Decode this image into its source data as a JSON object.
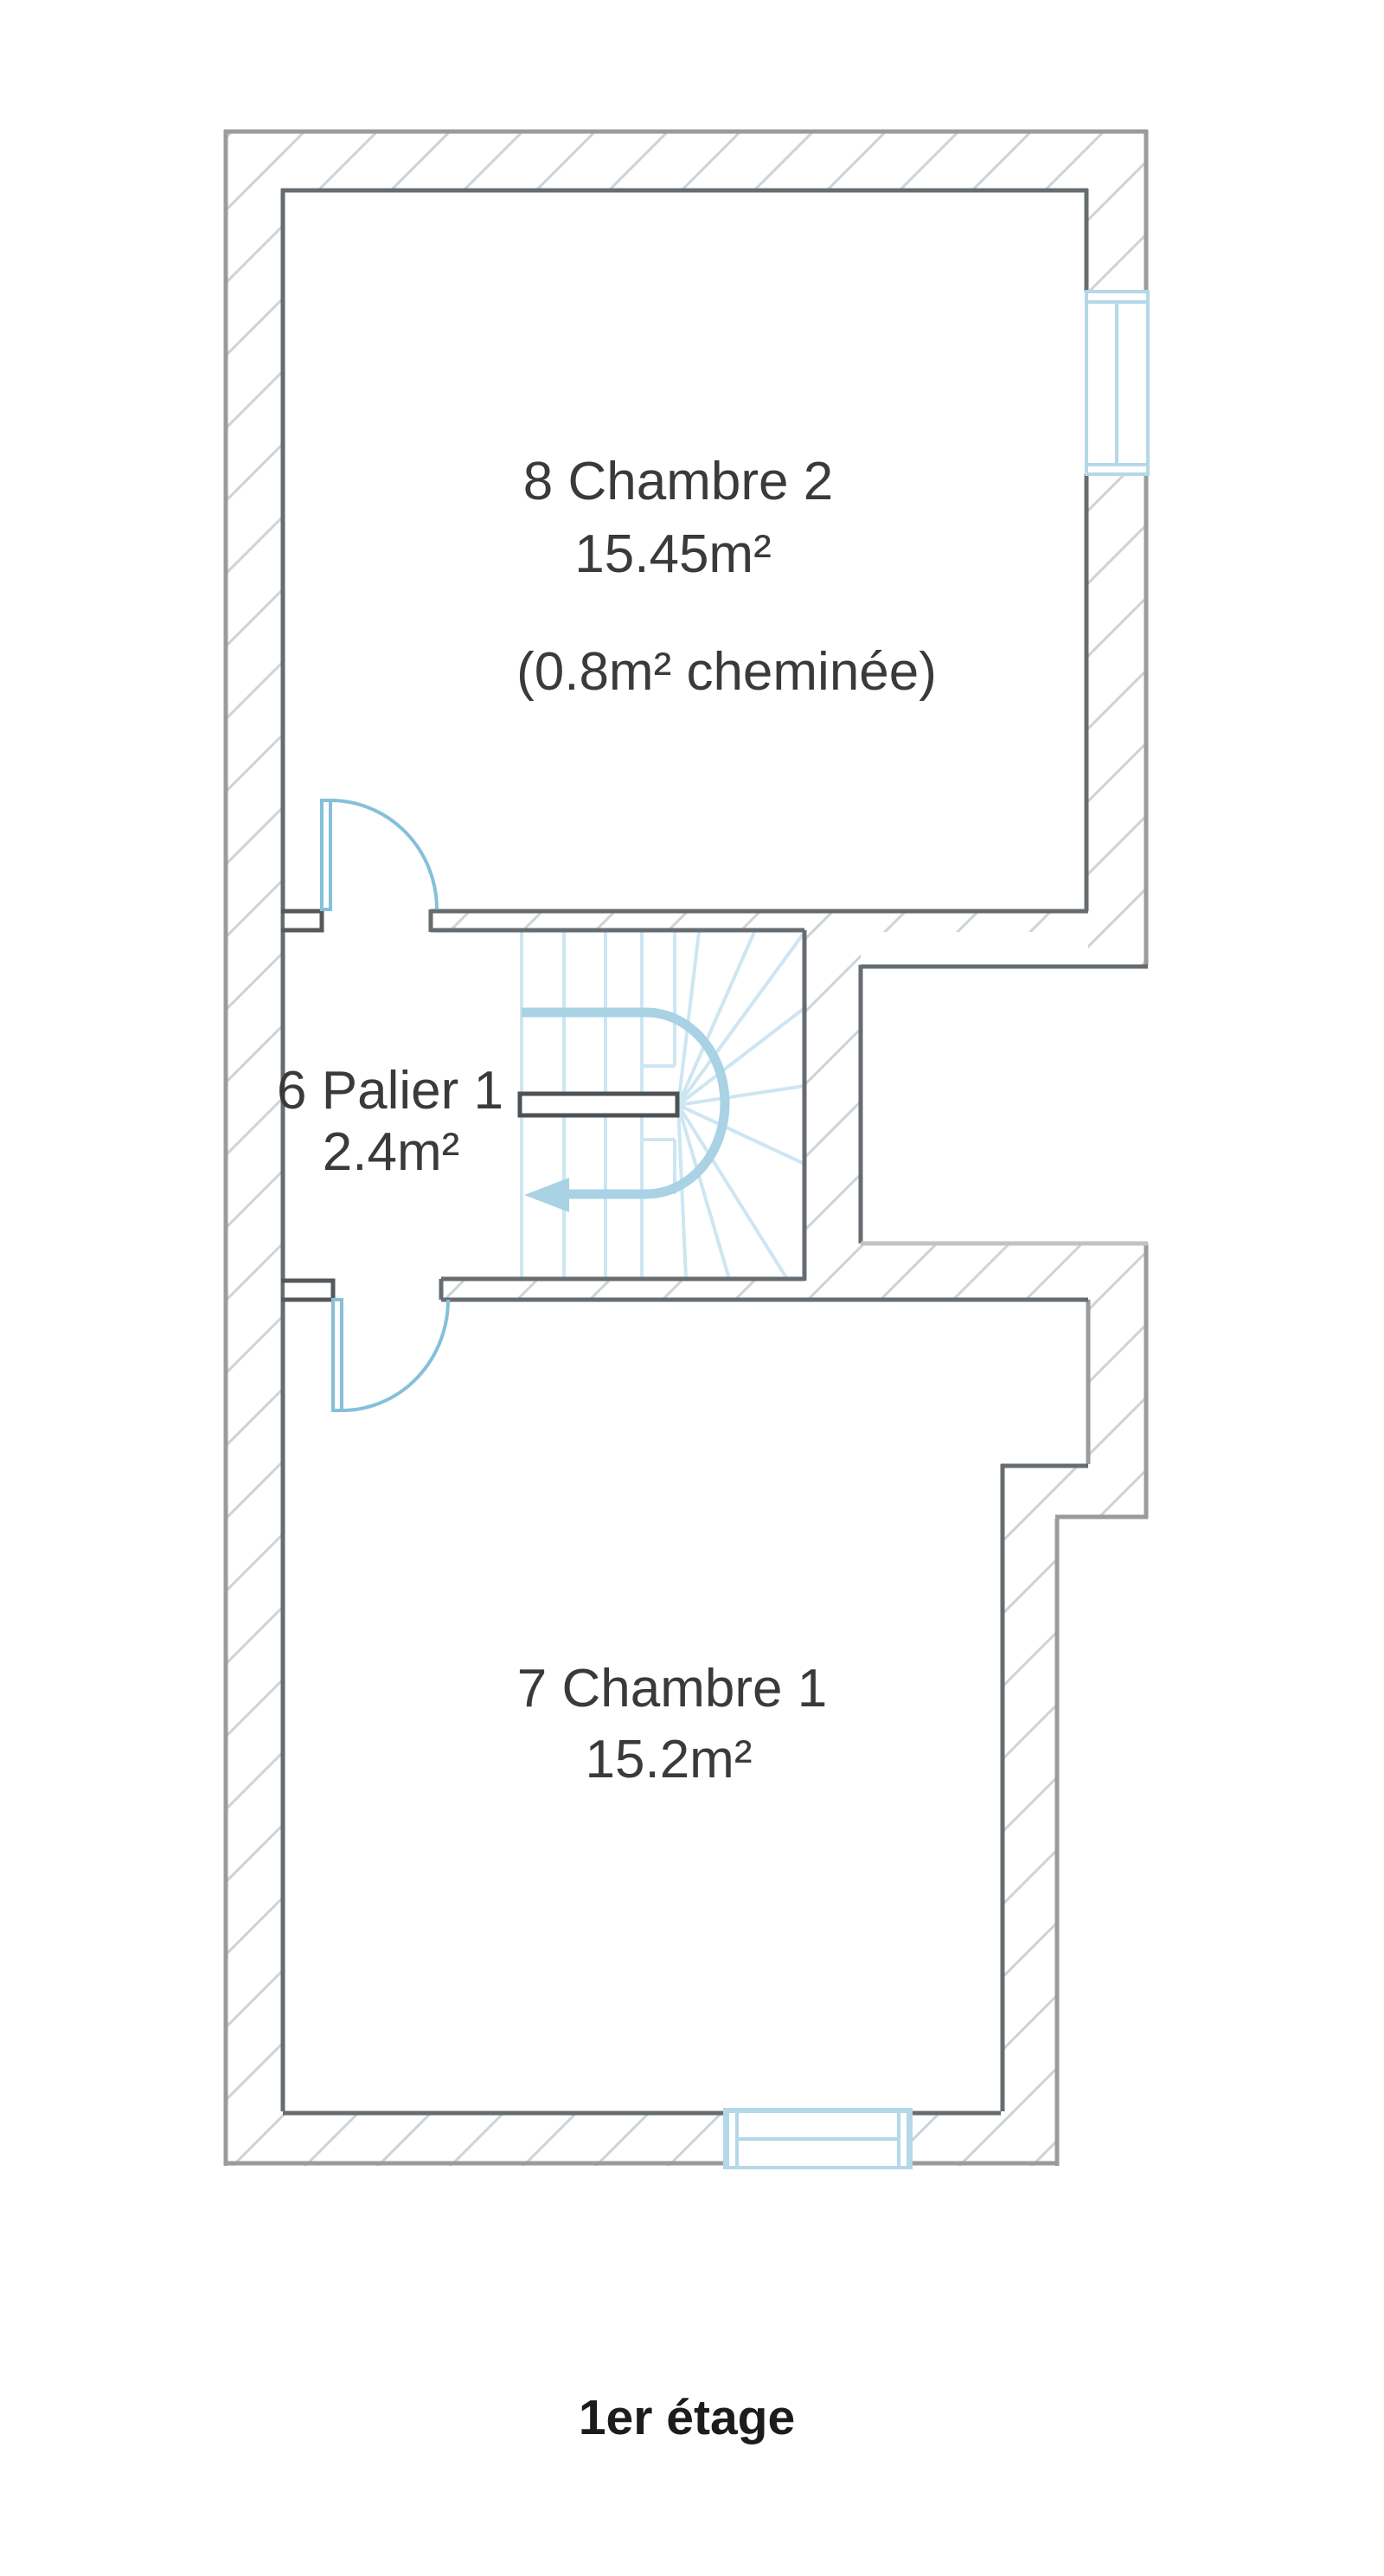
{
  "page": {
    "caption": "1er étage"
  },
  "rooms": {
    "chambre2": {
      "number_and_name": "8 Chambre 2",
      "area": "15.45m²",
      "note": "(0.8m² cheminée)"
    },
    "palier": {
      "number_and_name": "6 Palier 1",
      "area": "2.4m²"
    },
    "chambre1": {
      "number_and_name": "7 Chambre 1",
      "area": "15.2m²"
    }
  },
  "colors": {
    "background": "#ffffff",
    "wall_line_outer": "#9b9b9b",
    "wall_line_inner": "#676c70",
    "wall_hatch": "#ced3d6",
    "notch_bottom_line": "#c2c2c2",
    "stair_thick_blue": "#a9d2e5",
    "stair_thin_blue": "#cde6f2",
    "door_blue": "#85c0da",
    "window_blue": "#b4d8e8",
    "room_text": "#3a3a3a",
    "caption_text": "#1c1c1c"
  }
}
